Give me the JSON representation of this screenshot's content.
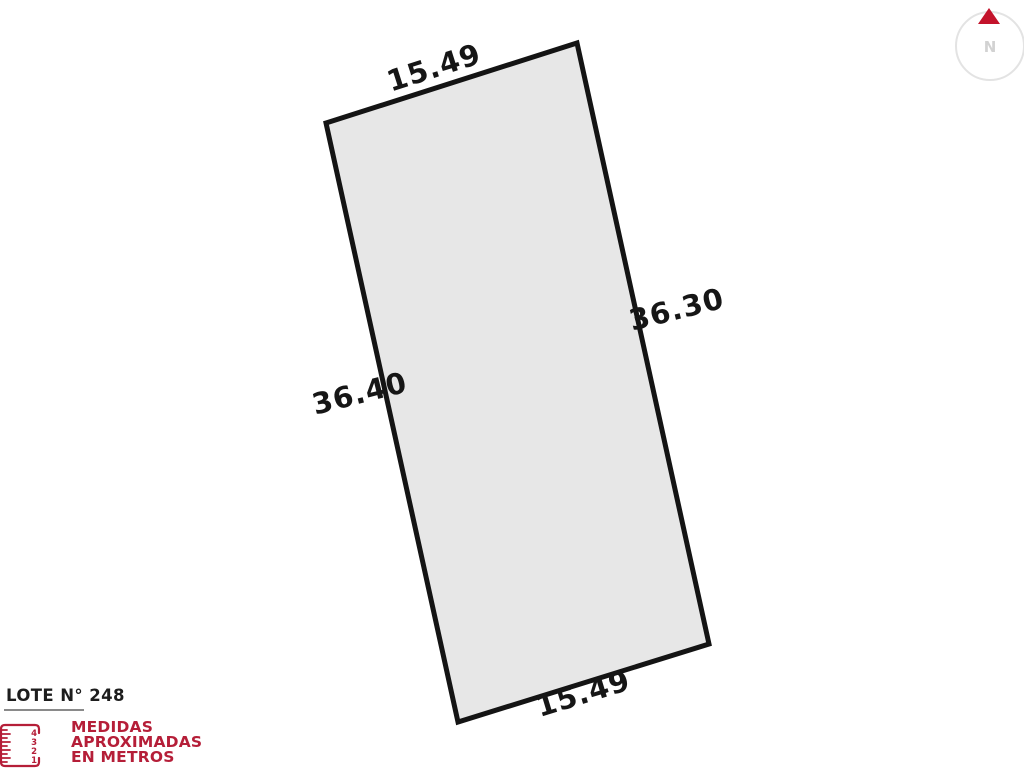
{
  "lot": {
    "measurements": {
      "top": "15.49",
      "right": "36.30",
      "left": "36.40",
      "bottom": "15.49"
    },
    "shape_fill": "#e7e7e7",
    "shape_stroke": "#141414"
  },
  "legend": {
    "title": "LOTE N° 248",
    "note_line1": "MEDIDAS",
    "note_line2": "APROXIMADAS",
    "note_line3": "EN METROS",
    "note_color": "#b51e38",
    "ruler_numbers": [
      "4",
      "3",
      "2",
      "1"
    ]
  },
  "compass": {
    "label": "N",
    "arrow_color": "#c3132b"
  }
}
